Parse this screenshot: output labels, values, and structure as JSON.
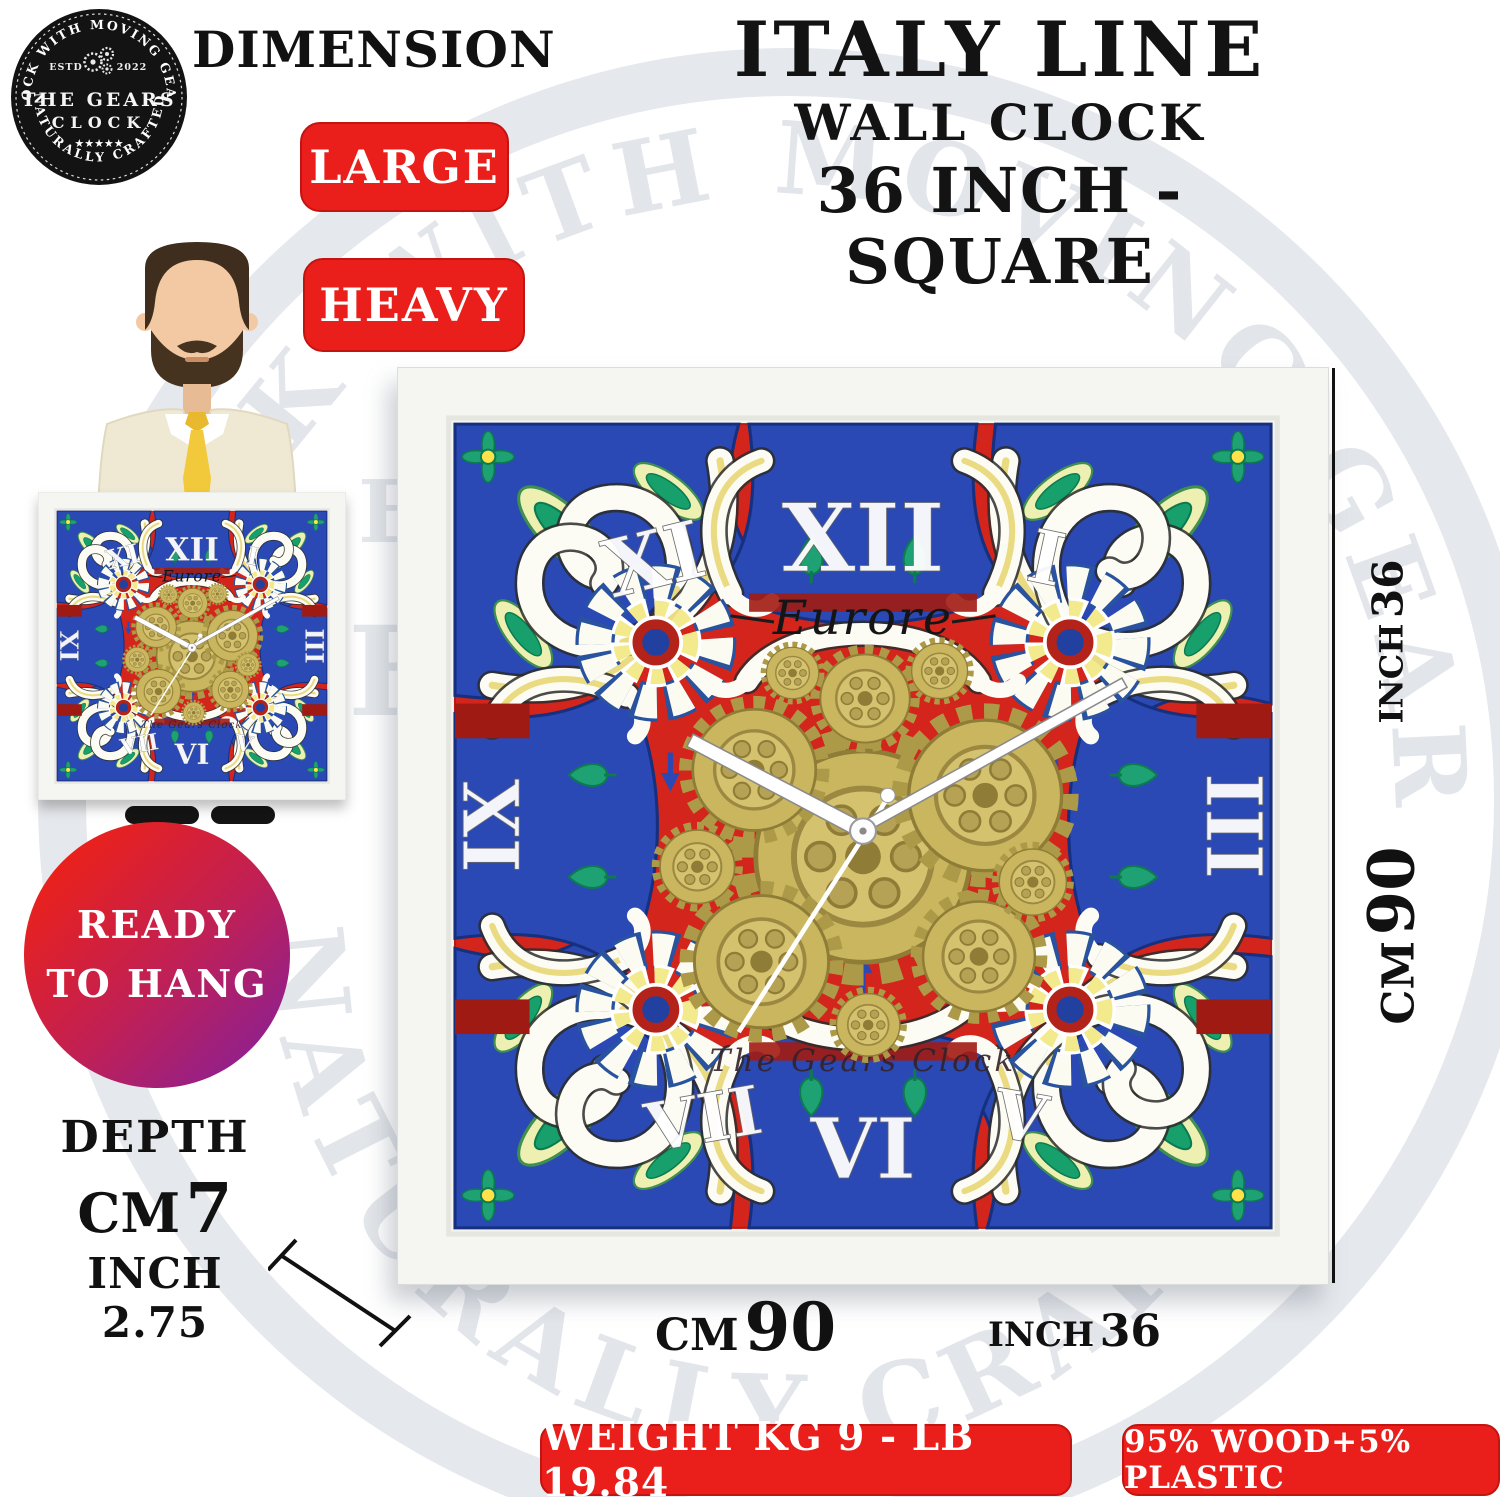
{
  "logo": {
    "arc_top": "CLOCK WITH MOVING GEARS",
    "estd": "ESTD",
    "year": "2022",
    "name_line1": "THE GEARS",
    "name_line2": "CLOCK",
    "stars": "★★★★★",
    "arc_bottom": "NATURALLY CRAFTED"
  },
  "header": {
    "dimension_label": "DIMENSION",
    "title_line1": "ITALY LINE",
    "title_line2": "WALL CLOCK",
    "title_line3": "36 INCH - SQUARE"
  },
  "badges": {
    "large": "LARGE",
    "heavy": "HEAVY",
    "ready_line1": "READY",
    "ready_line2": "TO HANG",
    "weight": "WEIGHT KG 9 - LB 19.84",
    "material": "95% WOOD+5% PLASTIC"
  },
  "depth": {
    "label": "DEPTH",
    "cm_label": "CM",
    "cm_value": "7",
    "inch_label": "INCH",
    "inch_value": "2.75"
  },
  "dimensions": {
    "cm_label": "CM",
    "cm_value": "90",
    "inch_label": "INCH",
    "inch_value": "36"
  },
  "clock": {
    "brand": "Eurore",
    "maker": "The Gears Clock",
    "numerals": {
      "eleven": "XI",
      "twelve": "XII",
      "one": "I",
      "nine": "IX",
      "three": "III",
      "seven": "VII",
      "six": "VI",
      "five": "V"
    }
  },
  "watermark": {
    "arc_top": "CLOCK WITH MOVING GEARS",
    "arc_bottom": "NATURALLY CRAFTED",
    "letter_e": "E",
    "letter_h": "H"
  },
  "colors": {
    "badge_red": "#ea1f1b",
    "ready_gradient_start": "#e9211c",
    "ready_gradient_end": "#8e2090",
    "clock_red": "#d3251c",
    "clock_dark_red": "#9e1a13",
    "clock_blue": "#2a49b4",
    "gear_gold": "#c9b65f",
    "leaf_green": "#17a06b",
    "frame_white": "#f5f5f2"
  }
}
